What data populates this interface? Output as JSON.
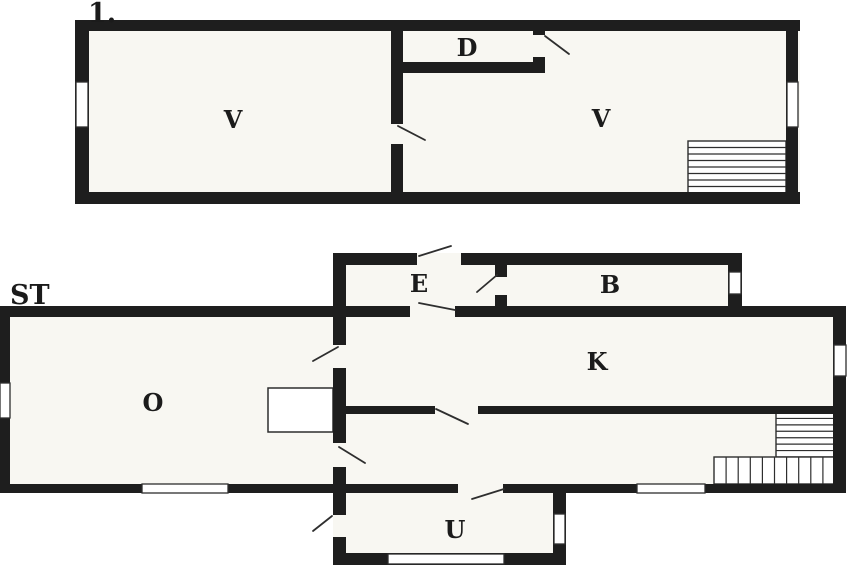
{
  "meta": {
    "title": "Two-storey house floor plan",
    "canvas": {
      "width": 848,
      "height": 565
    }
  },
  "style": {
    "background": "#ffffff",
    "floor_fill": "#f8f7f2",
    "wall_color": "#1e1e1e",
    "line_color": "#2e2e2e",
    "label_color": "#1b1b1b"
  },
  "floors": [
    {
      "name": "upper-floor",
      "floor_label": {
        "text": "1.",
        "x": 88,
        "y": 22,
        "size": 27
      },
      "regions": [
        [
          75,
          20,
          725,
          184
        ]
      ],
      "walls": [
        [
          75,
          20,
          725,
          11
        ],
        [
          75,
          192,
          725,
          12
        ],
        [
          75,
          20,
          14,
          184
        ],
        [
          786,
          20,
          12,
          184
        ],
        [
          391,
          20,
          12,
          104
        ],
        [
          391,
          144,
          12,
          60
        ],
        [
          391,
          62,
          154,
          11
        ],
        [
          533,
          20,
          12,
          15
        ],
        [
          533,
          57,
          12,
          16
        ]
      ],
      "windows": [
        [
          76,
          82,
          12,
          45
        ],
        [
          787,
          82,
          11,
          45
        ]
      ],
      "door_swings": [
        [
          545,
          36,
          569,
          54
        ],
        [
          398,
          126,
          425,
          140
        ]
      ],
      "stairs": [
        {
          "x": 688,
          "y": 141,
          "w": 98,
          "h": 52,
          "orient": "h",
          "count": 7
        }
      ],
      "fixtures": [],
      "room_labels": [
        {
          "text": "V",
          "x": 233,
          "y": 128
        },
        {
          "text": "D",
          "x": 467,
          "y": 56
        },
        {
          "text": "V",
          "x": 601,
          "y": 127
        }
      ]
    },
    {
      "name": "ground-floor",
      "floor_label": {
        "text": "ST",
        "x": 10,
        "y": 304,
        "size": 27
      },
      "regions": [
        [
          0,
          306,
          846,
          187
        ],
        [
          333,
          253,
          409,
          59
        ],
        [
          333,
          484,
          233,
          81
        ]
      ],
      "walls": [
        [
          0,
          306,
          346,
          11
        ],
        [
          333,
          253,
          84,
          12
        ],
        [
          461,
          253,
          281,
          12
        ],
        [
          728,
          253,
          14,
          61
        ],
        [
          346,
          306,
          64,
          11
        ],
        [
          455,
          306,
          391,
          11
        ],
        [
          333,
          253,
          13,
          92
        ],
        [
          333,
          368,
          13,
          75
        ],
        [
          333,
          467,
          13,
          48
        ],
        [
          333,
          537,
          13,
          28
        ],
        [
          495,
          253,
          12,
          24
        ],
        [
          495,
          295,
          12,
          17
        ],
        [
          346,
          406,
          89,
          8
        ],
        [
          478,
          406,
          368,
          8
        ],
        [
          833,
          306,
          13,
          187
        ],
        [
          0,
          306,
          10,
          187
        ],
        [
          0,
          484,
          458,
          9
        ],
        [
          503,
          484,
          343,
          9
        ],
        [
          553,
          484,
          13,
          81
        ],
        [
          333,
          553,
          233,
          12
        ]
      ],
      "windows": [
        [
          0,
          383,
          10,
          35
        ],
        [
          729,
          272,
          12,
          22
        ],
        [
          834,
          345,
          12,
          31
        ],
        [
          142,
          484,
          86,
          9
        ],
        [
          637,
          484,
          68,
          9
        ],
        [
          554,
          514,
          11,
          30
        ],
        [
          388,
          554,
          116,
          10
        ]
      ],
      "door_swings": [
        [
          419,
          256,
          451,
          246
        ],
        [
          497,
          275,
          477,
          292
        ],
        [
          419,
          303,
          455,
          310
        ],
        [
          338,
          347,
          313,
          361
        ],
        [
          339,
          447,
          365,
          463
        ],
        [
          436,
          409,
          468,
          424
        ],
        [
          472,
          499,
          504,
          489
        ],
        [
          332,
          516,
          313,
          531
        ]
      ],
      "stairs": [
        {
          "x": 776,
          "y": 412,
          "w": 59,
          "h": 45,
          "orient": "h",
          "count": 6
        },
        {
          "x": 714,
          "y": 457,
          "w": 121,
          "h": 27,
          "orient": "v",
          "count": 9
        }
      ],
      "fixtures": [
        [
          268,
          388,
          65,
          44
        ]
      ],
      "room_labels": [
        {
          "text": "O",
          "x": 153,
          "y": 411
        },
        {
          "text": "E",
          "x": 419,
          "y": 292
        },
        {
          "text": "B",
          "x": 610,
          "y": 293
        },
        {
          "text": "K",
          "x": 597,
          "y": 370
        },
        {
          "text": "U",
          "x": 455,
          "y": 538
        }
      ]
    }
  ]
}
